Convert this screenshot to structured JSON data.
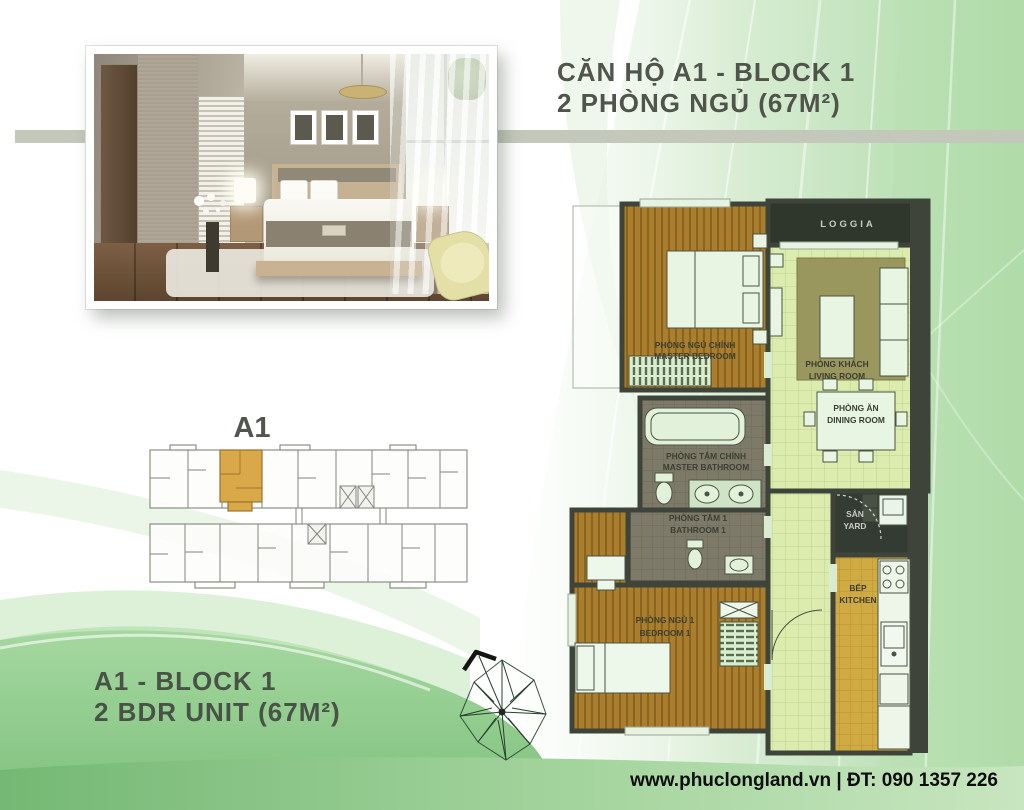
{
  "header": {
    "line1": "CĂN HỘ A1 - BLOCK 1",
    "line2": "2 PHÒNG NGỦ (67M²)"
  },
  "unit_summary": {
    "line1": "A1 - BLOCK 1",
    "line2": "2 BDR UNIT (67M²)"
  },
  "keyplan": {
    "unit_label": "A1"
  },
  "floorplan": {
    "rooms": {
      "master_bedroom": {
        "vi": "PHÒNG NGỦ CHÍNH",
        "en": "MASTER BEDROOM"
      },
      "living_room": {
        "vi": "PHÒNG KHÁCH",
        "en": "LIVING ROOM"
      },
      "dining_room": {
        "vi": "PHÒNG ĂN",
        "en": "DINING ROOM"
      },
      "master_bathroom": {
        "vi": "PHÒNG TẮM CHÍNH",
        "en": "MASTER BATHROOM"
      },
      "bathroom_1": {
        "vi": "PHÒNG TẮM 1",
        "en": "BATHROOM 1"
      },
      "bedroom_1": {
        "vi": "PHÒNG NGỦ 1",
        "en": "BEDROOM 1"
      },
      "kitchen": {
        "vi": "BẾP",
        "en": "KITCHEN"
      },
      "yard": {
        "vi": "SÂN",
        "en": "YARD"
      },
      "loggia": {
        "label": "LOGGIA"
      }
    }
  },
  "footer": {
    "contact": "www.phuclongland.vn | ĐT: 090 1357 226"
  },
  "colors": {
    "accent_green": "#8fca8c",
    "tile_green": "#dcecae",
    "wood": "#a97e2f",
    "kitchen_tile": "#d0aa42",
    "bath_tile": "#7d7a69",
    "wall": "#3e4439",
    "band_gray": "#c3c8bb",
    "highlight_unit": "#d9a848",
    "title_text": "#50544a"
  }
}
